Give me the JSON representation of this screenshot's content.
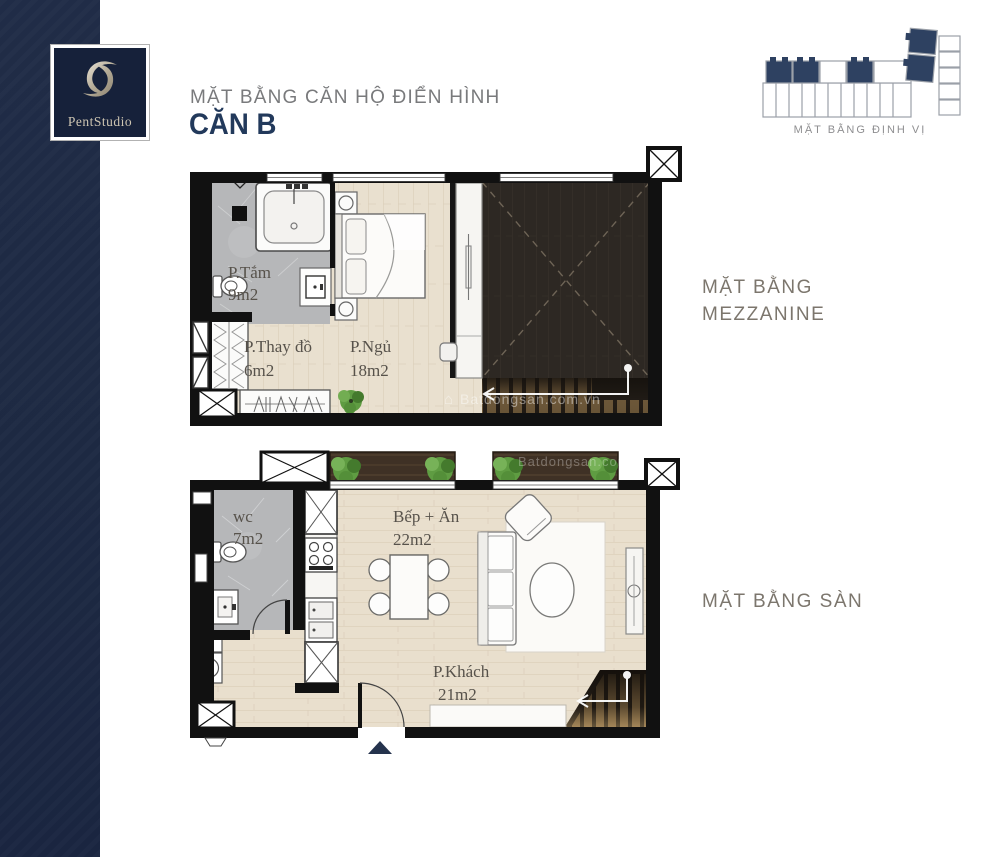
{
  "logo": {
    "brand": "PentStudio"
  },
  "header": {
    "title": "MẶT BẰNG CĂN HỘ ĐIỂN HÌNH",
    "unit": "CĂN B"
  },
  "locator": {
    "caption": "MẶT BẰNG ĐỊNH VỊ"
  },
  "sections": {
    "mezzanine_line1": "MẶT BẰNG",
    "mezzanine_line2": "MEZZANINE",
    "ground": "MẶT BẰNG SÀN"
  },
  "mezzanine_rooms": {
    "bath": {
      "name": "P.Tắm",
      "area": "9m2"
    },
    "dressing": {
      "name": "P.Thay đồ",
      "area": "6m2"
    },
    "bedroom": {
      "name": "P.Ngủ",
      "area": "18m2"
    }
  },
  "ground_rooms": {
    "wc": {
      "name": "wc",
      "area": "7m2"
    },
    "kitchen": {
      "name": "Bếp + Ăn",
      "area": "22m2"
    },
    "living": {
      "name": "P.Khách",
      "area": "21m2"
    }
  },
  "watermark": {
    "site": "Batdongsan.com.vn"
  },
  "colors": {
    "navy_stripe": "#1d2942",
    "logo_navy": "#16213a",
    "unit_navy": "#22395b",
    "title_gray": "#797a7c",
    "section_taupe": "#7c766d",
    "plan_text": "#57524b",
    "wood_floor": "#e9e0cf",
    "tile_gray": "#b6b7b9",
    "void_dark": "#2d2username8",
    "plant_green": "#5f9c42",
    "planter_brown": "#3f3125",
    "locator_unit_navy": "#2e4161"
  }
}
